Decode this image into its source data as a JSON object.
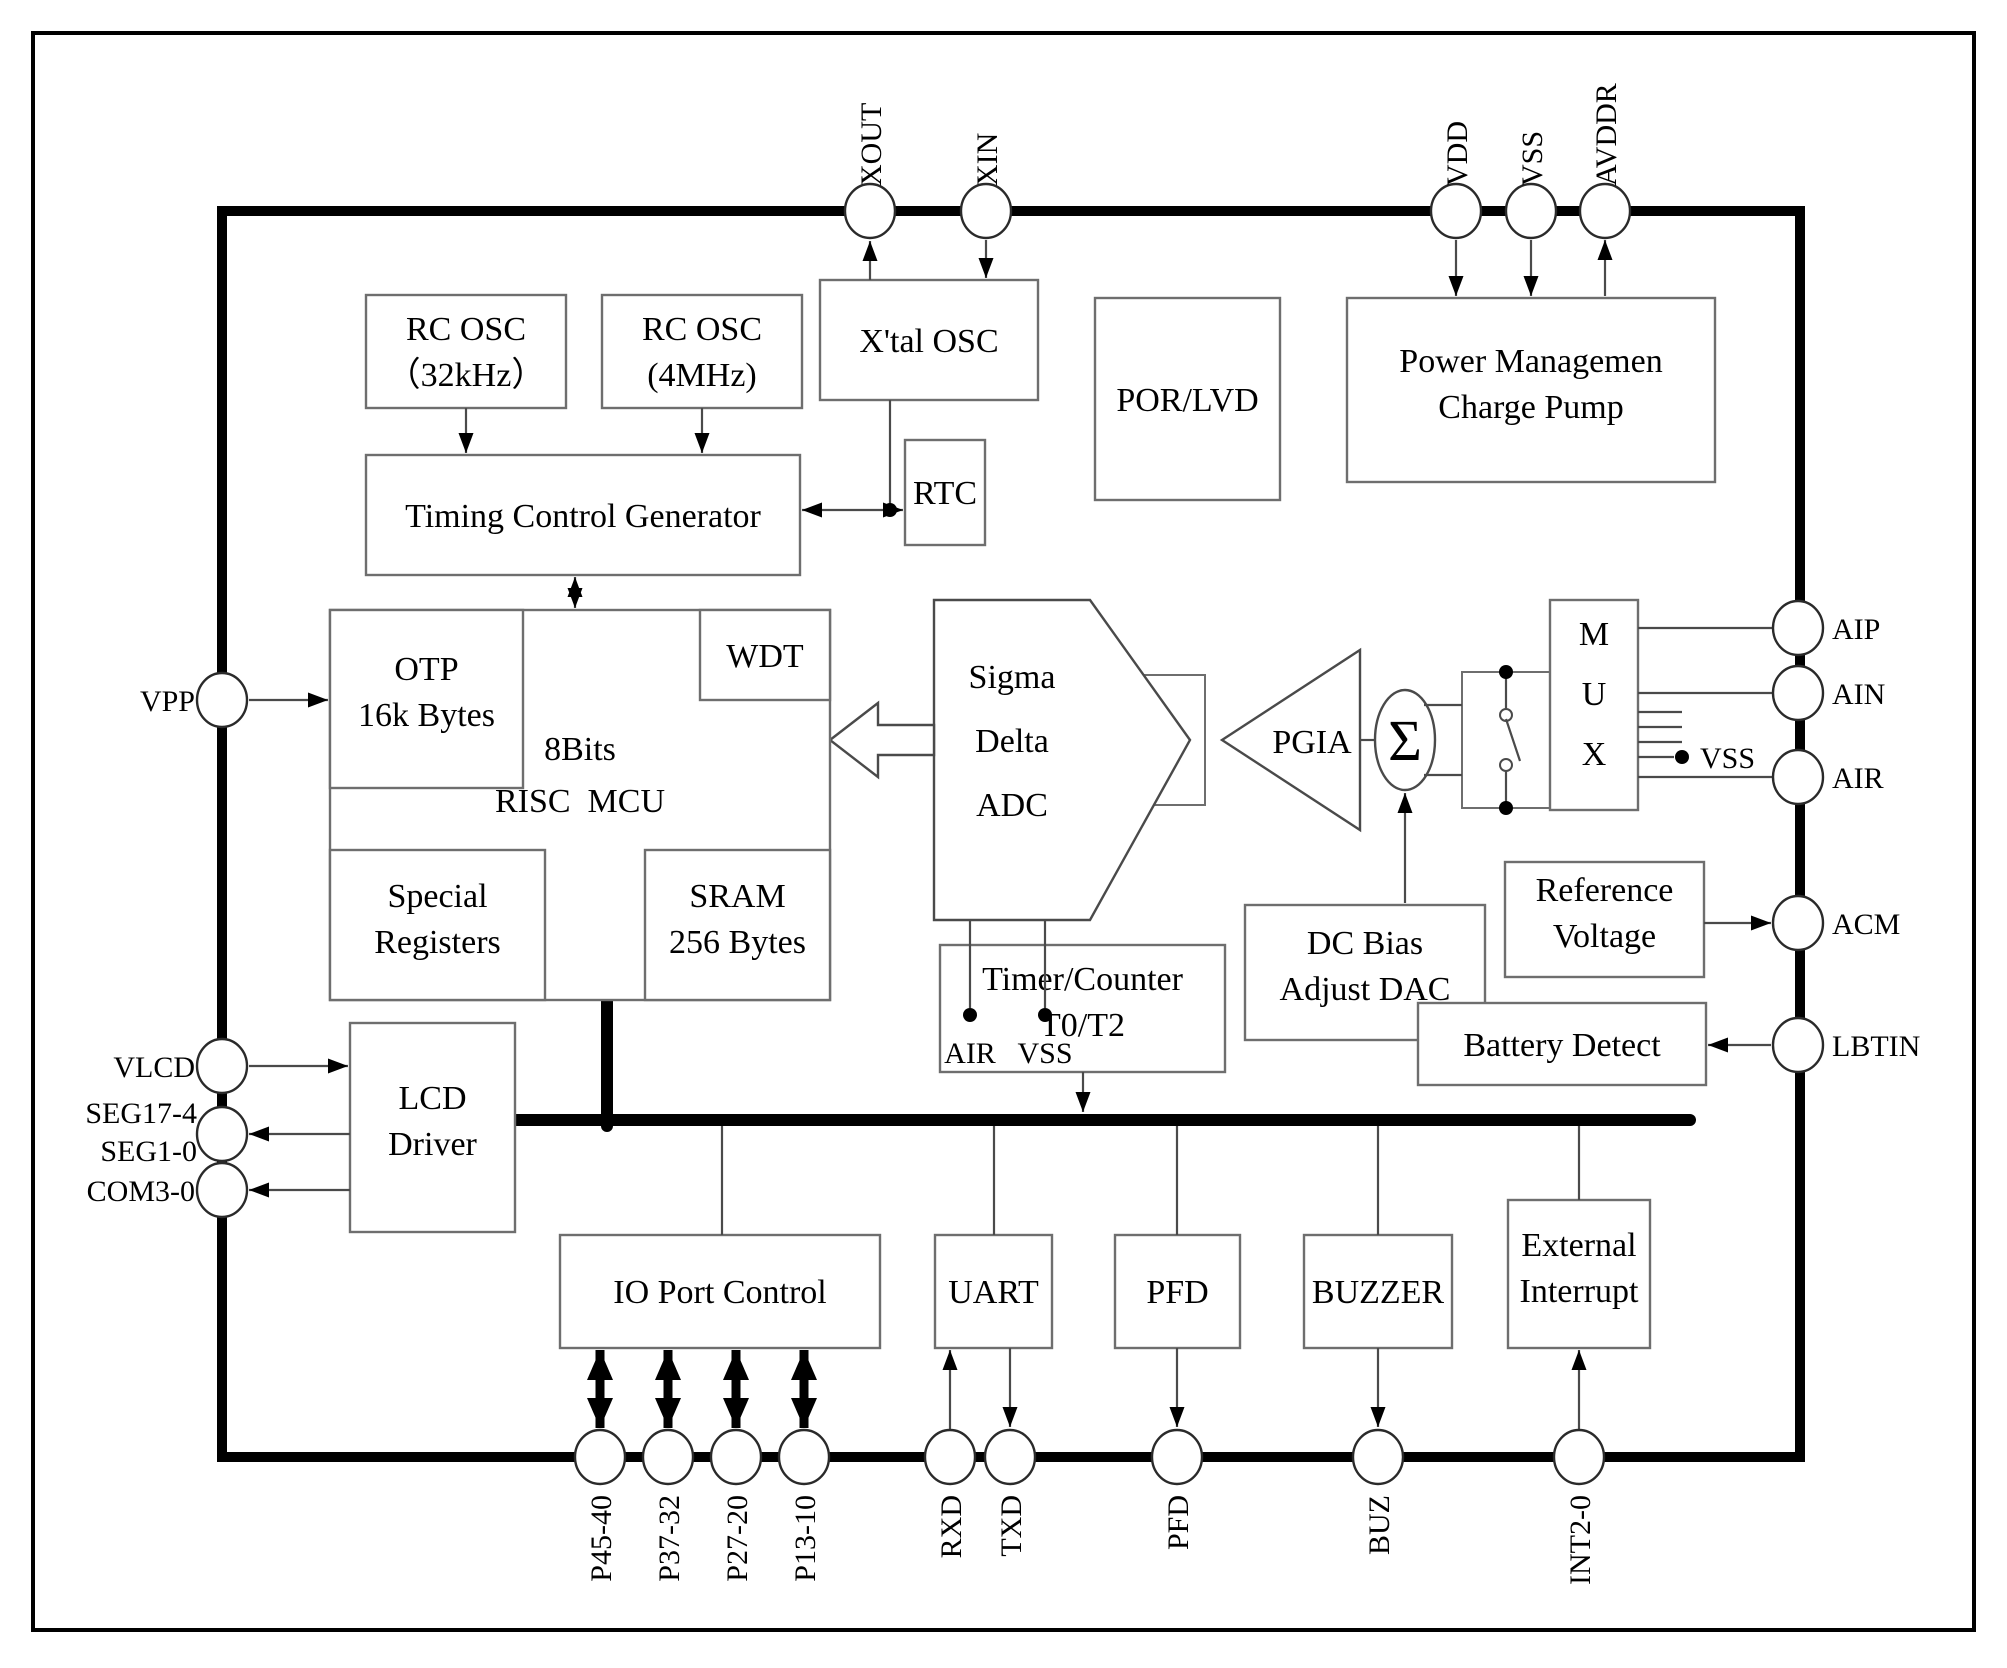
{
  "figure": {
    "width": 2007,
    "height": 1663,
    "bg": "#ffffff",
    "ink": "#000000",
    "box_stroke": "#6e6e6e",
    "wire_stroke": "#4a4a4a",
    "thick": "#000000"
  },
  "frame": {
    "x": 33,
    "y": 33,
    "w": 1941,
    "h": 1597,
    "stroke_w": 4
  },
  "chip_border": {
    "x": 222,
    "y": 211,
    "w": 1578,
    "h": 1246,
    "stroke_w": 10
  },
  "bus": {
    "segments": [
      {
        "x1": 515,
        "y1": 1120,
        "x2": 1690,
        "y2": 1120,
        "w": 12
      },
      {
        "x1": 607,
        "y1": 1000,
        "x2": 607,
        "y2": 1126,
        "w": 12
      }
    ]
  },
  "blocks": [
    {
      "id": "rc-osc-32k",
      "x": 366,
      "y": 295,
      "w": 200,
      "h": 113,
      "lines": [
        "RC OSC",
        "（32kHz）"
      ],
      "text_ys": [
        340,
        386
      ]
    },
    {
      "id": "rc-osc-4m",
      "x": 602,
      "y": 295,
      "w": 200,
      "h": 113,
      "lines": [
        "RC OSC",
        "(4MHz)"
      ],
      "text_ys": [
        340,
        386
      ]
    },
    {
      "id": "xtal-osc",
      "x": 820,
      "y": 280,
      "w": 218,
      "h": 120,
      "lines": [
        "X'tal OSC"
      ],
      "text_ys": [
        352
      ]
    },
    {
      "id": "por-lvd",
      "x": 1095,
      "y": 298,
      "w": 185,
      "h": 202,
      "lines": [
        "POR/LVD"
      ],
      "text_ys": [
        411
      ]
    },
    {
      "id": "power-mgmt",
      "x": 1347,
      "y": 298,
      "w": 368,
      "h": 184,
      "lines": [
        "Power Managemen",
        "Charge Pump"
      ],
      "text_ys": [
        372,
        418
      ]
    },
    {
      "id": "timing-control",
      "x": 366,
      "y": 455,
      "w": 434,
      "h": 120,
      "lines": [
        "Timing Control Generator"
      ],
      "text_ys": [
        527
      ]
    },
    {
      "id": "rtc",
      "x": 905,
      "y": 440,
      "w": 80,
      "h": 105,
      "lines": [
        "RTC"
      ],
      "text_ys": [
        504
      ]
    },
    {
      "id": "risc-mcu",
      "x": 330,
      "y": 610,
      "w": 500,
      "h": 390,
      "lines": [
        "8Bits",
        "RISC  MCU"
      ],
      "text_ys": [
        760,
        812
      ]
    },
    {
      "id": "otp",
      "x": 330,
      "y": 610,
      "w": 193,
      "h": 178,
      "lines": [
        "OTP",
        "16k Bytes"
      ],
      "text_ys": [
        680,
        726
      ]
    },
    {
      "id": "wdt",
      "x": 700,
      "y": 610,
      "w": 130,
      "h": 90,
      "lines": [
        "WDT"
      ],
      "text_ys": [
        667
      ]
    },
    {
      "id": "special-registers",
      "x": 330,
      "y": 850,
      "w": 215,
      "h": 150,
      "lines": [
        "Special",
        "Registers"
      ],
      "text_ys": [
        907,
        953
      ]
    },
    {
      "id": "sram",
      "x": 645,
      "y": 850,
      "w": 185,
      "h": 150,
      "lines": [
        "SRAM",
        "256 Bytes"
      ],
      "text_ys": [
        907,
        953
      ]
    },
    {
      "id": "lcd-driver",
      "x": 350,
      "y": 1023,
      "w": 165,
      "h": 209,
      "lines": [
        "LCD",
        "Driver"
      ],
      "text_ys": [
        1109,
        1155
      ]
    },
    {
      "id": "timer-counter",
      "x": 940,
      "y": 945,
      "w": 285,
      "h": 127,
      "lines": [
        "Timer/Counter",
        "T0/T2"
      ],
      "text_ys": [
        990,
        1036
      ]
    },
    {
      "id": "dc-bias-dac",
      "x": 1245,
      "y": 905,
      "w": 240,
      "h": 135,
      "lines": [
        "DC Bias",
        "Adjust DAC"
      ],
      "text_ys": [
        954,
        1000
      ]
    },
    {
      "id": "reference-voltage",
      "x": 1505,
      "y": 862,
      "w": 199,
      "h": 115,
      "lines": [
        "Reference",
        "Voltage"
      ],
      "text_ys": [
        901,
        947
      ]
    },
    {
      "id": "battery-detect",
      "x": 1418,
      "y": 1003,
      "w": 288,
      "h": 82,
      "lines": [
        "Battery Detect"
      ],
      "text_ys": [
        1056
      ]
    },
    {
      "id": "io-port-control",
      "x": 560,
      "y": 1235,
      "w": 320,
      "h": 113,
      "lines": [
        "IO Port Control"
      ],
      "text_ys": [
        1303
      ]
    },
    {
      "id": "uart",
      "x": 935,
      "y": 1235,
      "w": 117,
      "h": 113,
      "lines": [
        "UART"
      ],
      "text_ys": [
        1303
      ]
    },
    {
      "id": "pfd",
      "x": 1115,
      "y": 1235,
      "w": 125,
      "h": 113,
      "lines": [
        "PFD"
      ],
      "text_ys": [
        1303
      ]
    },
    {
      "id": "buzzer",
      "x": 1304,
      "y": 1235,
      "w": 148,
      "h": 113,
      "lines": [
        "BUZZER"
      ],
      "text_ys": [
        1303
      ]
    },
    {
      "id": "external-interrupt",
      "x": 1508,
      "y": 1200,
      "w": 142,
      "h": 148,
      "lines": [
        "External",
        "Interrupt"
      ],
      "text_ys": [
        1256,
        1302
      ]
    },
    {
      "id": "mux",
      "x": 1550,
      "y": 600,
      "w": 88,
      "h": 210,
      "lines": [
        "M",
        "U",
        "X"
      ],
      "text_ys": [
        645,
        705,
        765
      ]
    }
  ],
  "plain_rects": [
    {
      "id": "adc-stub",
      "x": 1140,
      "y": 675,
      "w": 65,
      "h": 130
    },
    {
      "id": "switch-box",
      "x": 1462,
      "y": 672,
      "w": 88,
      "h": 136
    }
  ],
  "polygons": [
    {
      "id": "sigma-delta-adc",
      "points": "934,600 1090,600 1190,740 1090,920 934,920",
      "lines": [
        "Sigma",
        "Delta",
        "ADC"
      ],
      "text_x": 1012,
      "text_ys": [
        688,
        752,
        816
      ]
    },
    {
      "id": "pgia-amp",
      "points": "1222,740 1360,650 1360,830",
      "lines": [
        "PGIA"
      ],
      "text_x": 1312,
      "text_ys": [
        753
      ]
    },
    {
      "id": "adc-to-mcu-arrow",
      "points": "830,740 878,703 878,725 934,725 934,755 878,755 878,777"
    }
  ],
  "sum_node": {
    "cx": 1405,
    "cy": 740,
    "rx": 30,
    "ry": 50,
    "symbol": "Σ"
  },
  "switch": {
    "stems": [
      {
        "x1": 1506,
        "y1": 672,
        "x2": 1506,
        "y2": 709
      },
      {
        "x1": 1506,
        "y1": 771,
        "x2": 1506,
        "y2": 808
      }
    ],
    "contacts": [
      {
        "cx": 1506,
        "cy": 715,
        "r": 6
      },
      {
        "cx": 1506,
        "cy": 765,
        "r": 6
      }
    ],
    "lever": {
      "x1": 1506,
      "y1": 719,
      "x2": 1520,
      "y2": 761
    }
  },
  "wires": [
    {
      "x1": 890,
      "y1": 400,
      "x2": 890,
      "y2": 510
    },
    {
      "x1": 722,
      "y1": 1126,
      "x2": 722,
      "y2": 1235
    },
    {
      "x1": 994,
      "y1": 1126,
      "x2": 994,
      "y2": 1235
    },
    {
      "x1": 1177,
      "y1": 1126,
      "x2": 1177,
      "y2": 1235
    },
    {
      "x1": 1378,
      "y1": 1126,
      "x2": 1378,
      "y2": 1235
    },
    {
      "x1": 1579,
      "y1": 1126,
      "x2": 1579,
      "y2": 1200
    },
    {
      "x1": 1638,
      "y1": 628,
      "x2": 1773,
      "y2": 628
    },
    {
      "x1": 1638,
      "y1": 693,
      "x2": 1773,
      "y2": 693
    },
    {
      "x1": 1638,
      "y1": 712,
      "x2": 1682,
      "y2": 712
    },
    {
      "x1": 1638,
      "y1": 727,
      "x2": 1682,
      "y2": 727
    },
    {
      "x1": 1638,
      "y1": 742,
      "x2": 1682,
      "y2": 742
    },
    {
      "x1": 1638,
      "y1": 757,
      "x2": 1674,
      "y2": 757
    },
    {
      "x1": 1638,
      "y1": 777,
      "x2": 1773,
      "y2": 777
    },
    {
      "x1": 1360,
      "y1": 740,
      "x2": 1375,
      "y2": 740
    },
    {
      "x1": 1424,
      "y1": 705,
      "x2": 1462,
      "y2": 705
    },
    {
      "x1": 1424,
      "y1": 775,
      "x2": 1462,
      "y2": 775
    },
    {
      "x1": 970,
      "y1": 920,
      "x2": 970,
      "y2": 1008
    },
    {
      "x1": 1045,
      "y1": 920,
      "x2": 1045,
      "y2": 1008
    }
  ],
  "arrows": [
    {
      "id": "rc32-to-tcg",
      "x1": 466,
      "y1": 408,
      "x2": 466,
      "y2": 453,
      "head": "end"
    },
    {
      "id": "rc4-to-tcg",
      "x1": 702,
      "y1": 408,
      "x2": 702,
      "y2": 453,
      "head": "end"
    },
    {
      "id": "xtal-to-xout",
      "x1": 870,
      "y1": 280,
      "x2": 870,
      "y2": 241,
      "head": "end"
    },
    {
      "id": "xin-to-xtal",
      "x1": 986,
      "y1": 240,
      "x2": 986,
      "y2": 278,
      "head": "end"
    },
    {
      "id": "vdd-to-pm",
      "x1": 1456,
      "y1": 240,
      "x2": 1456,
      "y2": 296,
      "head": "end"
    },
    {
      "id": "vss-to-pm",
      "x1": 1531,
      "y1": 240,
      "x2": 1531,
      "y2": 296,
      "head": "end"
    },
    {
      "id": "pm-to-avddr",
      "x1": 1605,
      "y1": 296,
      "x2": 1605,
      "y2": 240,
      "head": "end"
    },
    {
      "id": "tcg-rtc-link",
      "x1": 802,
      "y1": 510,
      "x2": 903,
      "y2": 510,
      "head": "both"
    },
    {
      "id": "tcg-mcu-link",
      "x1": 575,
      "y1": 577,
      "x2": 575,
      "y2": 608,
      "head": "both"
    },
    {
      "id": "vpp-to-otp",
      "x1": 249,
      "y1": 700,
      "x2": 328,
      "y2": 700,
      "head": "end"
    },
    {
      "id": "vlcd-to-lcd",
      "x1": 249,
      "y1": 1066,
      "x2": 348,
      "y2": 1066,
      "head": "end"
    },
    {
      "id": "lcd-to-seg",
      "x1": 350,
      "y1": 1134,
      "x2": 249,
      "y2": 1134,
      "head": "end"
    },
    {
      "id": "lcd-to-com",
      "x1": 350,
      "y1": 1190,
      "x2": 249,
      "y2": 1190,
      "head": "end"
    },
    {
      "id": "dcbias-to-sum",
      "x1": 1405,
      "y1": 903,
      "x2": 1405,
      "y2": 793,
      "head": "end"
    },
    {
      "id": "refv-to-acm",
      "x1": 1704,
      "y1": 923,
      "x2": 1771,
      "y2": 923,
      "head": "end"
    },
    {
      "id": "lbtin-to-battery",
      "x1": 1771,
      "y1": 1045,
      "x2": 1708,
      "y2": 1045,
      "head": "end"
    },
    {
      "id": "timer-to-bus",
      "x1": 1083,
      "y1": 1072,
      "x2": 1083,
      "y2": 1112,
      "head": "end"
    },
    {
      "id": "rxd-to-uart",
      "x1": 950,
      "y1": 1429,
      "x2": 950,
      "y2": 1350,
      "head": "end"
    },
    {
      "id": "uart-to-txd",
      "x1": 1010,
      "y1": 1348,
      "x2": 1010,
      "y2": 1427,
      "head": "end"
    },
    {
      "id": "pfd-to-pin",
      "x1": 1177,
      "y1": 1348,
      "x2": 1177,
      "y2": 1427,
      "head": "end"
    },
    {
      "id": "buzzer-to-pin",
      "x1": 1378,
      "y1": 1348,
      "x2": 1378,
      "y2": 1427,
      "head": "end"
    },
    {
      "id": "int-to-extint",
      "x1": 1579,
      "y1": 1429,
      "x2": 1579,
      "y2": 1350,
      "head": "end"
    },
    {
      "id": "io-port-bus-1",
      "x1": 600,
      "y1": 1350,
      "x2": 600,
      "y2": 1428,
      "head": "both",
      "thick": true
    },
    {
      "id": "io-port-bus-2",
      "x1": 668,
      "y1": 1350,
      "x2": 668,
      "y2": 1428,
      "head": "both",
      "thick": true
    },
    {
      "id": "io-port-bus-3",
      "x1": 736,
      "y1": 1350,
      "x2": 736,
      "y2": 1428,
      "head": "both",
      "thick": true
    },
    {
      "id": "io-port-bus-4",
      "x1": 804,
      "y1": 1350,
      "x2": 804,
      "y2": 1428,
      "head": "both",
      "thick": true
    }
  ],
  "junction_dots": [
    {
      "cx": 890,
      "cy": 510
    },
    {
      "cx": 970,
      "cy": 1015
    },
    {
      "cx": 1045,
      "cy": 1015
    },
    {
      "cx": 1682,
      "cy": 757
    },
    {
      "cx": 1506,
      "cy": 672
    },
    {
      "cx": 1506,
      "cy": 808
    }
  ],
  "pins": [
    {
      "id": "xout",
      "side": "top",
      "cx": 870,
      "cy": 211,
      "label": "XOUT"
    },
    {
      "id": "xin",
      "side": "top",
      "cx": 986,
      "cy": 211,
      "label": "XIN"
    },
    {
      "id": "vdd",
      "side": "top",
      "cx": 1456,
      "cy": 211,
      "label": "VDD"
    },
    {
      "id": "vss-top",
      "side": "top",
      "cx": 1531,
      "cy": 211,
      "label": "VSS"
    },
    {
      "id": "avddr",
      "side": "top",
      "cx": 1605,
      "cy": 211,
      "label": "AVDDR"
    },
    {
      "id": "vpp",
      "side": "left",
      "cx": 222,
      "cy": 700,
      "label": "VPP"
    },
    {
      "id": "vlcd",
      "side": "left",
      "cx": 222,
      "cy": 1066,
      "label": "VLCD"
    },
    {
      "id": "seg",
      "side": "left",
      "cx": 222,
      "cy": 1134,
      "label": ""
    },
    {
      "id": "com3-0",
      "side": "left",
      "cx": 222,
      "cy": 1190,
      "label": "COM3-0"
    },
    {
      "id": "aip",
      "side": "right",
      "cx": 1798,
      "cy": 628,
      "label": "AIP"
    },
    {
      "id": "ain",
      "side": "right",
      "cx": 1798,
      "cy": 693,
      "label": "AIN"
    },
    {
      "id": "air",
      "side": "right",
      "cx": 1798,
      "cy": 777,
      "label": "AIR"
    },
    {
      "id": "acm",
      "side": "right",
      "cx": 1798,
      "cy": 923,
      "label": "ACM"
    },
    {
      "id": "lbtin",
      "side": "right",
      "cx": 1798,
      "cy": 1045,
      "label": "LBTIN"
    },
    {
      "id": "p45-40",
      "side": "bottom",
      "cx": 600,
      "cy": 1457,
      "label": "P45-40"
    },
    {
      "id": "p37-32",
      "side": "bottom",
      "cx": 668,
      "cy": 1457,
      "label": "P37-32"
    },
    {
      "id": "p27-20",
      "side": "bottom",
      "cx": 736,
      "cy": 1457,
      "label": "P27-20"
    },
    {
      "id": "p13-10",
      "side": "bottom",
      "cx": 804,
      "cy": 1457,
      "label": "P13-10"
    },
    {
      "id": "rxd",
      "side": "bottom",
      "cx": 950,
      "cy": 1457,
      "label": "RXD"
    },
    {
      "id": "txd",
      "side": "bottom",
      "cx": 1010,
      "cy": 1457,
      "label": "TXD"
    },
    {
      "id": "pfd-pin",
      "side": "bottom",
      "cx": 1177,
      "cy": 1457,
      "label": "PFD"
    },
    {
      "id": "buz",
      "side": "bottom",
      "cx": 1378,
      "cy": 1457,
      "label": "BUZ"
    },
    {
      "id": "int2-0",
      "side": "bottom",
      "cx": 1579,
      "cy": 1457,
      "label": "INT2-0"
    }
  ],
  "free_labels": [
    {
      "id": "seg17-4-label",
      "text": "SEG17-4",
      "x": 197,
      "y": 1123,
      "anchor": "end",
      "fs": 30
    },
    {
      "id": "seg1-0-label",
      "text": "SEG1-0",
      "x": 197,
      "y": 1161,
      "anchor": "end",
      "fs": 30
    },
    {
      "id": "adc-air-label",
      "text": "AIR",
      "x": 970,
      "y": 1063,
      "anchor": "middle",
      "fs": 30
    },
    {
      "id": "adc-vss-label",
      "text": "VSS",
      "x": 1045,
      "y": 1063,
      "anchor": "middle",
      "fs": 30
    },
    {
      "id": "mux-vss-label",
      "text": "VSS",
      "x": 1700,
      "y": 768,
      "anchor": "start",
      "fs": 30
    }
  ]
}
